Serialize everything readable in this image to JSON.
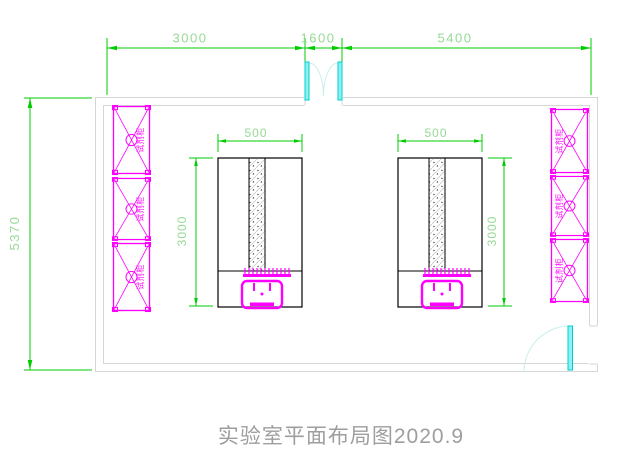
{
  "drawing": {
    "title": "实验室平面布局图2020.9",
    "dimensions": {
      "top_segments": [
        "3000",
        "1600",
        "5400"
      ],
      "room_height": "5370"
    },
    "benches": [
      {
        "width": "500",
        "depth": "3000"
      },
      {
        "width": "500",
        "depth": "3000"
      }
    ],
    "cabinets": {
      "left": [
        "试剂柜",
        "试剂柜",
        "试剂柜"
      ],
      "right": [
        "试剂柜",
        "试剂柜",
        "试剂柜"
      ]
    },
    "colors": {
      "dimension_line": "#00cc00",
      "dimension_text": "#96d996",
      "cabinet": "#ff00ff",
      "door": "#00cfcf",
      "wall": "#d6d6d6",
      "bench_outline": "#000000",
      "title_text": "#9e9e9e"
    }
  }
}
